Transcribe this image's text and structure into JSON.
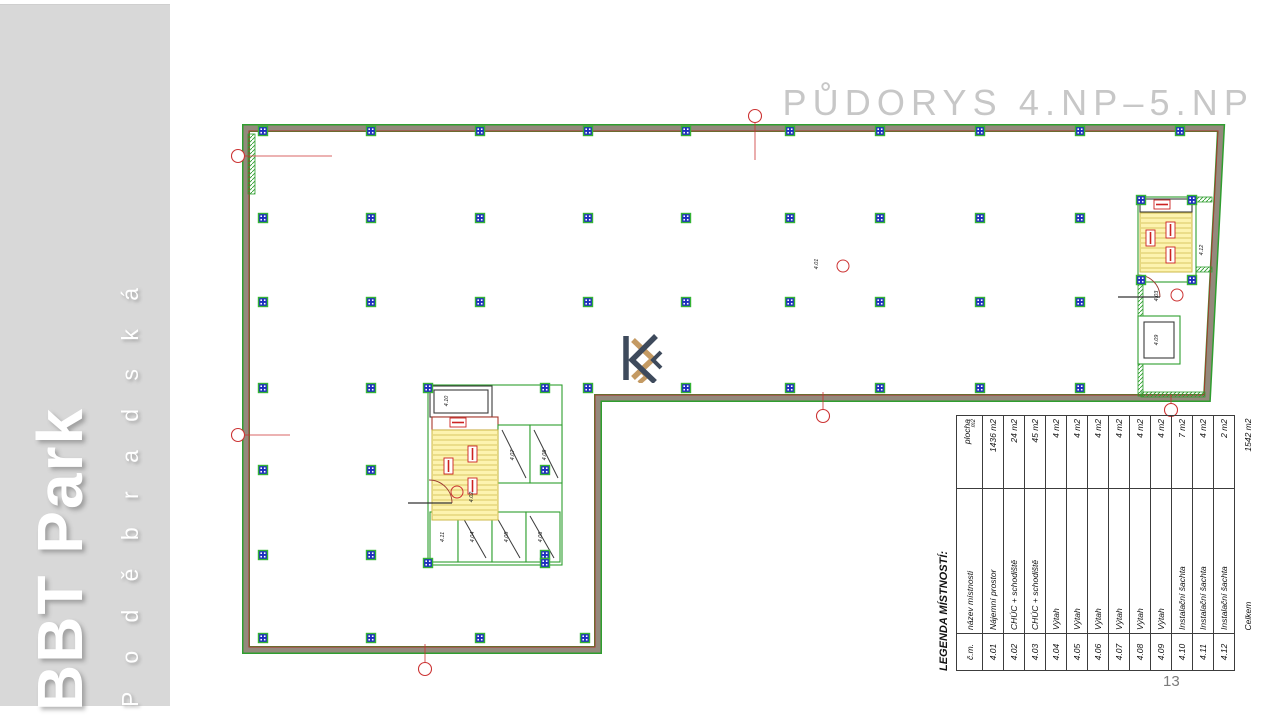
{
  "slide": {
    "title": "PŮDORYS 4.NP–5.NP",
    "page_number": "13"
  },
  "sidebar": {
    "project": "BBT Park",
    "street": "P o d ě b r a d s k á"
  },
  "logo": {
    "dark": "#3e4a5c",
    "gold": "#c49a63"
  },
  "legend_table": {
    "title": "LEGENDA MÍSTNOSTÍ:",
    "col_headers": {
      "number": "č.m.",
      "name": "název místnosti",
      "area": "plocha",
      "area_unit": "m2"
    },
    "rows": [
      {
        "number": "4.01",
        "name": "Nájemní prostor",
        "area": "1436 m2"
      },
      {
        "number": "4.02",
        "name": "CHÚC + schodiště",
        "area": "24 m2"
      },
      {
        "number": "4.03",
        "name": "CHÚC + schodiště",
        "area": "45 m2"
      },
      {
        "number": "4.04",
        "name": "Výtah",
        "area": "4 m2"
      },
      {
        "number": "4.05",
        "name": "Výtah",
        "area": "4 m2"
      },
      {
        "number": "4.06",
        "name": "Výtah",
        "area": "4 m2"
      },
      {
        "number": "4.07",
        "name": "Výtah",
        "area": "4 m2"
      },
      {
        "number": "4.08",
        "name": "Výtah",
        "area": "4 m2"
      },
      {
        "number": "4.09",
        "name": "Výtah",
        "area": "4 m2"
      },
      {
        "number": "4.10",
        "name": "Instalační šachta",
        "area": "7 m2"
      },
      {
        "number": "4.11",
        "name": "Instalační šachta",
        "area": "4 m2"
      },
      {
        "number": "4.12",
        "name": "Instalační šachta",
        "area": "2 m2"
      }
    ],
    "total": {
      "name": "Celkem",
      "area": "1542 m2"
    }
  },
  "plan": {
    "colors": {
      "wall_green": "#2f9e2f",
      "wall_core": "#94897c",
      "wall_red": "#a8382c",
      "column_fill": "#1e2ec0",
      "column_border": "#35b335",
      "stair_fill": "#fdf3af",
      "stair_hatch": "#cdb84a",
      "label_red": "#cc2222",
      "axis_red": "#cc3333",
      "dark": "#3b3b3b"
    },
    "outline": [
      [
        246,
        128
      ],
      [
        1221,
        128
      ],
      [
        1207,
        398
      ],
      [
        598,
        398
      ],
      [
        598,
        650
      ],
      [
        246,
        650
      ]
    ],
    "outline_inner": [
      [
        249,
        131
      ],
      [
        1218,
        131
      ],
      [
        1204,
        395
      ],
      [
        595,
        395
      ],
      [
        595,
        647
      ],
      [
        249,
        647
      ]
    ],
    "column_rows": [
      {
        "y": 131,
        "xs": [
          263,
          371,
          480,
          588,
          686,
          790,
          880,
          980,
          1080,
          1180
        ]
      },
      {
        "y": 218,
        "xs": [
          263,
          371,
          480,
          588,
          686,
          790,
          880,
          980,
          1080
        ]
      },
      {
        "y": 302,
        "xs": [
          263,
          371,
          480,
          588,
          686,
          790,
          880,
          980,
          1080
        ]
      },
      {
        "y": 388,
        "xs": [
          263,
          371,
          686,
          790,
          880,
          980,
          1080
        ]
      },
      {
        "y": 470,
        "xs": [
          263,
          371,
          545
        ]
      },
      {
        "y": 555,
        "xs": [
          263,
          371,
          545
        ]
      },
      {
        "y": 638,
        "xs": [
          263,
          371,
          480,
          585
        ]
      }
    ],
    "extra_columns": [
      [
        428,
        388
      ],
      [
        545,
        388
      ],
      [
        428,
        563
      ],
      [
        545,
        563
      ],
      [
        1141,
        200
      ],
      [
        1192,
        200
      ],
      [
        1141,
        280
      ],
      [
        1192,
        280
      ],
      [
        588,
        388
      ]
    ],
    "hatches": [
      [
        248,
        134,
        7,
        60
      ],
      [
        479,
        506,
        11,
        56
      ],
      [
        1196,
        197,
        16,
        5
      ],
      [
        1196,
        267,
        16,
        5
      ],
      [
        1138,
        282,
        5,
        114
      ],
      [
        1141,
        392,
        64,
        5
      ]
    ],
    "shapes": [
      {
        "t": "rect",
        "x": 428,
        "y": 385,
        "w": 134,
        "h": 180,
        "s": "green"
      },
      {
        "t": "rect",
        "x": 430,
        "y": 386,
        "w": 62,
        "h": 31,
        "s": "dark"
      },
      {
        "t": "rect",
        "x": 434,
        "y": 390,
        "w": 54,
        "h": 23,
        "s": "dark"
      },
      {
        "t": "rect",
        "x": 432,
        "y": 417,
        "w": 66,
        "h": 13,
        "s": "red"
      },
      {
        "t": "rect",
        "x": 498,
        "y": 425,
        "w": 32,
        "h": 58,
        "s": "green"
      },
      {
        "t": "rect",
        "x": 530,
        "y": 425,
        "w": 32,
        "h": 58,
        "s": "green"
      },
      {
        "t": "rect",
        "x": 430,
        "y": 512,
        "w": 28,
        "h": 50,
        "s": "green"
      },
      {
        "t": "rect",
        "x": 458,
        "y": 512,
        "w": 34,
        "h": 50,
        "s": "green"
      },
      {
        "t": "rect",
        "x": 492,
        "y": 512,
        "w": 34,
        "h": 50,
        "s": "green"
      },
      {
        "t": "rect",
        "x": 526,
        "y": 512,
        "w": 34,
        "h": 50,
        "s": "green"
      },
      {
        "t": "line",
        "x1": 502,
        "y1": 430,
        "x2": 526,
        "y2": 478,
        "s": "dark"
      },
      {
        "t": "line",
        "x1": 534,
        "y1": 430,
        "x2": 558,
        "y2": 478,
        "s": "dark"
      },
      {
        "t": "line",
        "x1": 462,
        "y1": 516,
        "x2": 486,
        "y2": 558,
        "s": "dark"
      },
      {
        "t": "line",
        "x1": 496,
        "y1": 516,
        "x2": 520,
        "y2": 558,
        "s": "dark"
      },
      {
        "t": "line",
        "x1": 530,
        "y1": 516,
        "x2": 554,
        "y2": 558,
        "s": "dark"
      },
      {
        "t": "rect",
        "x": 1138,
        "y": 197,
        "w": 58,
        "h": 85,
        "s": "green"
      },
      {
        "t": "rect",
        "x": 1140,
        "y": 199,
        "w": 52,
        "h": 13,
        "s": "dark"
      },
      {
        "t": "rect",
        "x": 1138,
        "y": 316,
        "w": 42,
        "h": 48,
        "s": "green"
      },
      {
        "t": "rect",
        "x": 1144,
        "y": 322,
        "w": 30,
        "h": 36,
        "s": "dark"
      }
    ],
    "stairs": [
      {
        "x": 432,
        "y": 430,
        "w": 66,
        "h": 90
      },
      {
        "x": 1140,
        "y": 213,
        "w": 52,
        "h": 59
      }
    ],
    "red_tags": [
      [
        450,
        418,
        16,
        9
      ],
      [
        468,
        446,
        9,
        16
      ],
      [
        468,
        478,
        9,
        16
      ],
      [
        444,
        458,
        9,
        16
      ],
      [
        1154,
        200,
        16,
        9
      ],
      [
        1146,
        230,
        9,
        16
      ],
      [
        1166,
        222,
        9,
        16
      ],
      [
        1166,
        247,
        9,
        16
      ]
    ],
    "axis_markers": [
      {
        "cx": 238,
        "cy": 156,
        "x2": 332,
        "y2": 156
      },
      {
        "cx": 238,
        "cy": 435,
        "x2": 290,
        "y2": 435
      },
      {
        "cx": 755,
        "cy": 116,
        "x2": 755,
        "y2": 160
      },
      {
        "cx": 823,
        "cy": 416,
        "x2": 823,
        "y2": 392
      },
      {
        "cx": 425,
        "cy": 669,
        "x2": 425,
        "y2": 644
      },
      {
        "cx": 1171,
        "cy": 410,
        "x2": 1171,
        "y2": 395
      }
    ],
    "room_tags": [
      [
        843,
        266
      ],
      [
        457,
        492
      ],
      [
        1177,
        295
      ]
    ],
    "room_labels": [
      {
        "x": 818,
        "y": 264,
        "text": "4.01"
      },
      {
        "x": 473,
        "y": 497,
        "text": "4.02"
      },
      {
        "x": 1158,
        "y": 296,
        "text": "4.03"
      },
      {
        "x": 474,
        "y": 537,
        "text": "4.04"
      },
      {
        "x": 508,
        "y": 537,
        "text": "4.05"
      },
      {
        "x": 542,
        "y": 537,
        "text": "4.06"
      },
      {
        "x": 514,
        "y": 455,
        "text": "4.07"
      },
      {
        "x": 546,
        "y": 455,
        "text": "4.08"
      },
      {
        "x": 1158,
        "y": 340,
        "text": "4.09"
      },
      {
        "x": 448,
        "y": 401,
        "text": "4.10"
      },
      {
        "x": 444,
        "y": 537,
        "text": "4.11"
      },
      {
        "x": 1203,
        "y": 250,
        "text": "4.12"
      }
    ],
    "doors": [
      {
        "leaf": [
          [
            408,
            503
          ],
          [
            452,
            503
          ]
        ],
        "arc": "M452,503 A23,23 0 0 0 429,480"
      },
      {
        "leaf": [
          [
            1118,
            297
          ],
          [
            1160,
            297
          ]
        ],
        "arc": "M1160,297 A22,22 0 0 0 1138,275"
      }
    ]
  }
}
